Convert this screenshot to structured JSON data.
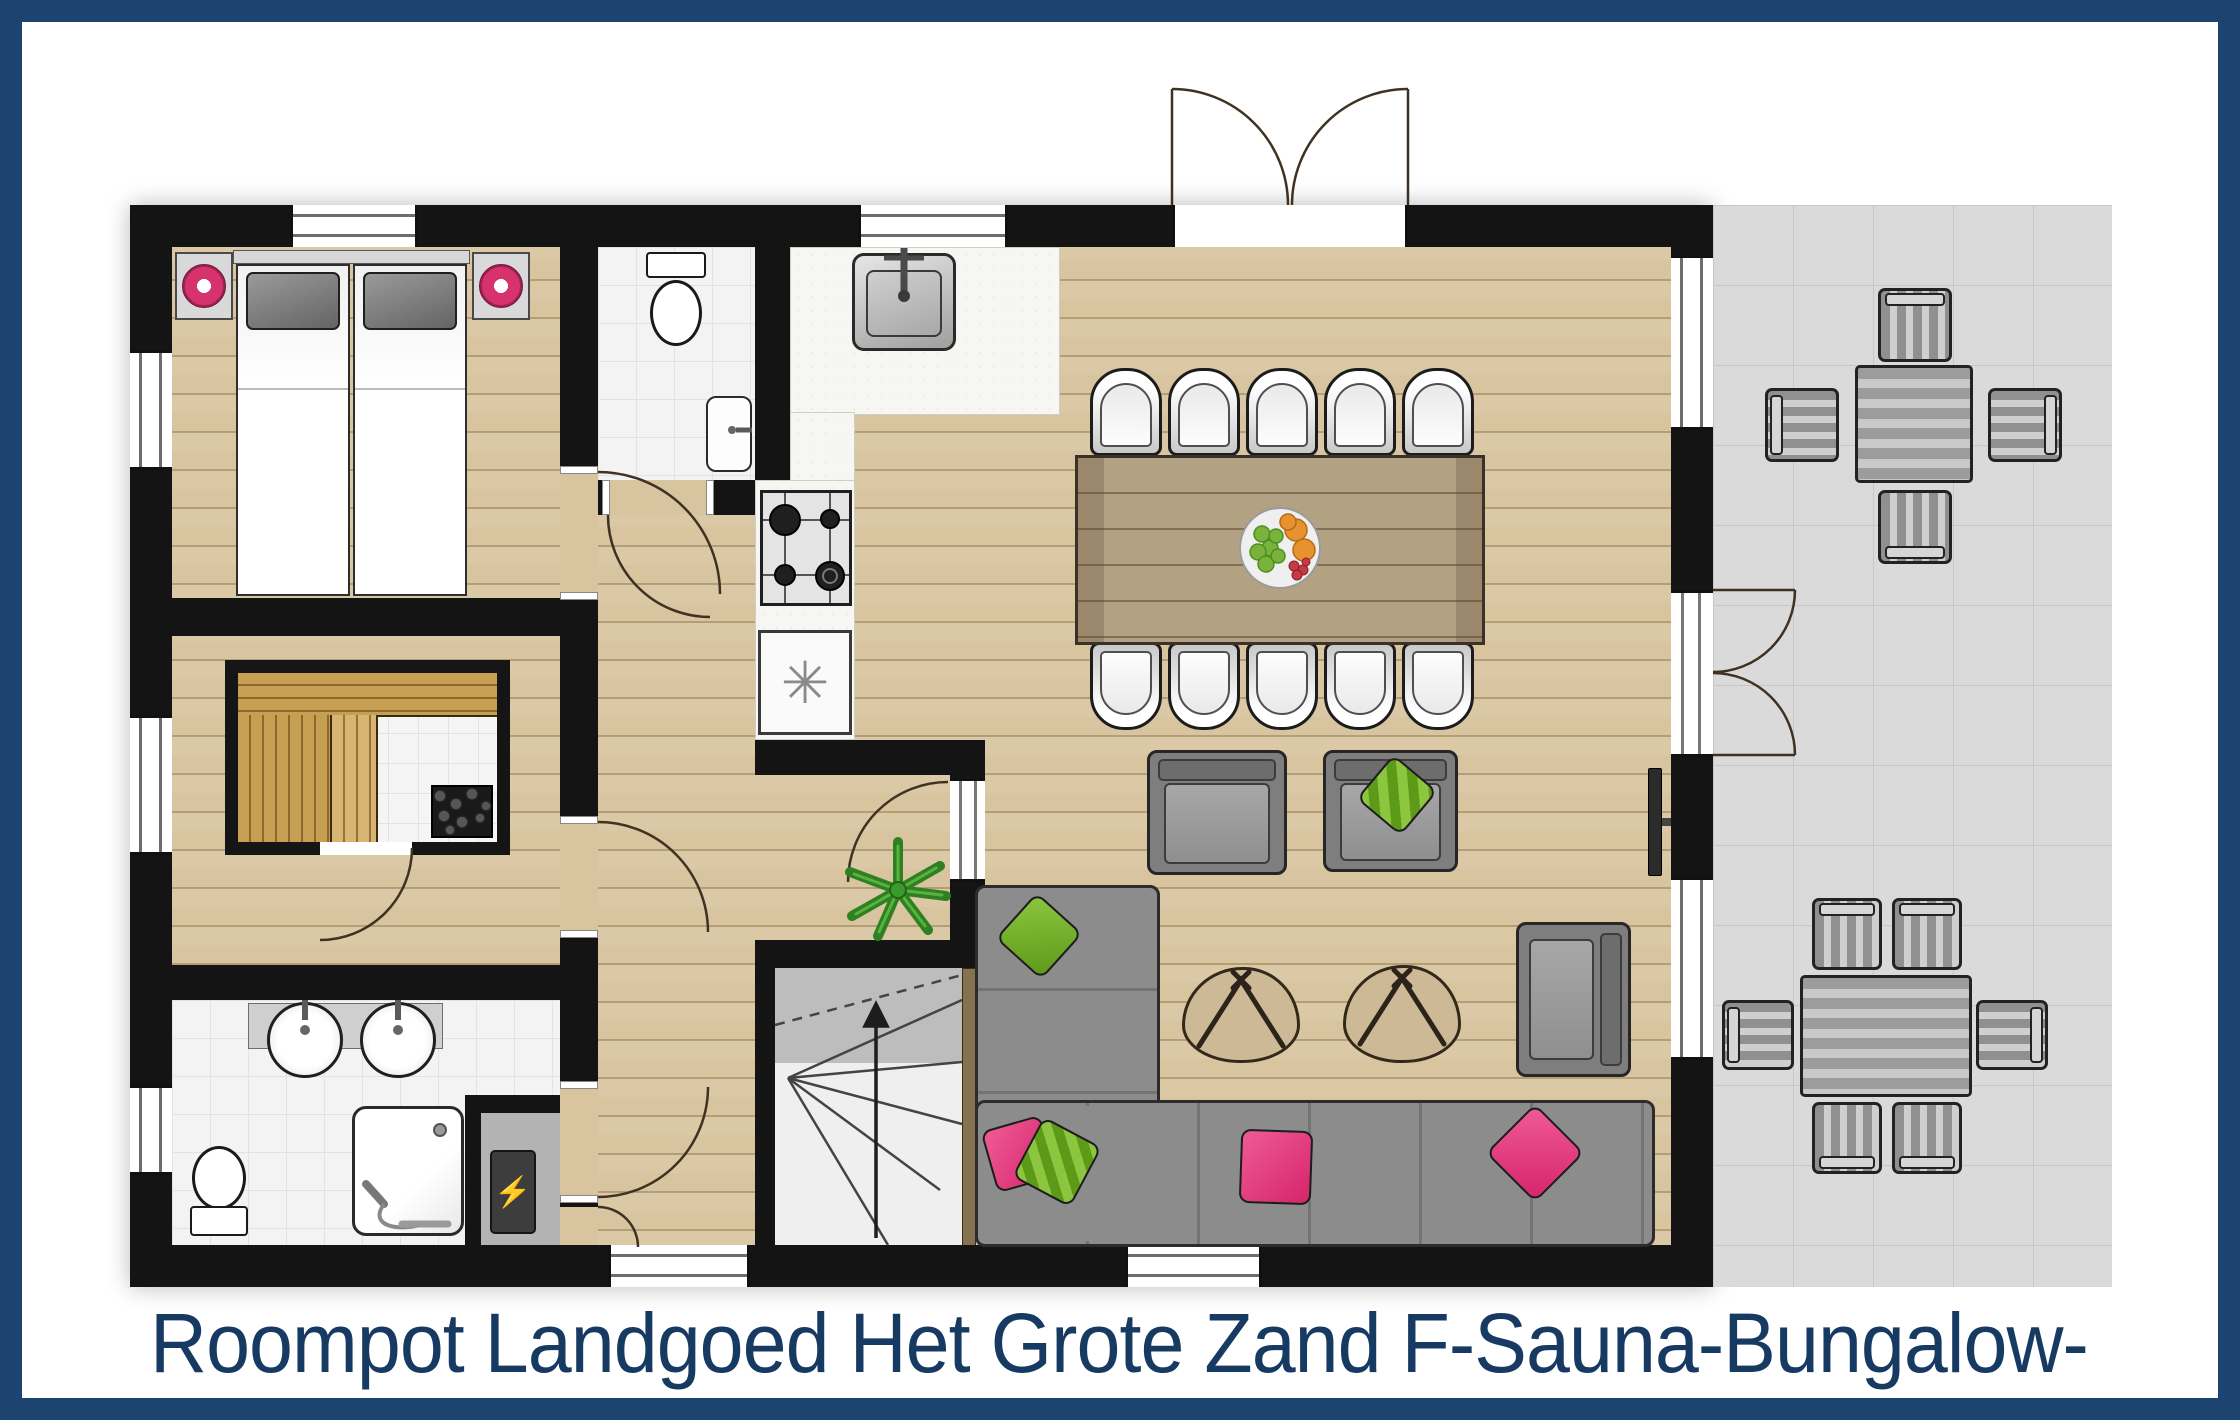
{
  "caption": {
    "text": "Roompot Landgoed Het Grote Zand F-Sauna-Bungalow-"
  },
  "symbols": {
    "freezer": "✳",
    "boiler": "⚡"
  },
  "colors": {
    "frame_navy": "#1d4370",
    "caption_navy": "#173a63",
    "wall_black": "#141414",
    "wood_floor": "#d8c49e",
    "tile_white": "#f3f3f3",
    "patio_gray": "#dadada",
    "sauna_wood": "#c79f52",
    "sofa_gray": "#8c8c8c",
    "accent_pink": "#d6336c",
    "accent_green": "#7fb32a",
    "table_wood": "#b3a184"
  },
  "legend": {
    "rooms": [
      "bedroom-1",
      "toilet-room",
      "kitchen",
      "dining-area",
      "living-room",
      "bedroom-2-with-sauna",
      "bathroom",
      "technical-closet",
      "hallway",
      "staircase",
      "terrace"
    ],
    "furniture_icons": [
      "double-bed",
      "nightstand-lamp",
      "toilet",
      "hand-basin",
      "kitchen-sink",
      "gas-hob",
      "freezer",
      "dining-table-10-chairs",
      "fruit-bowl",
      "corner-sofa",
      "armchair",
      "side-table",
      "lounge-chair",
      "tv",
      "plant",
      "sauna-bench",
      "sauna-heater",
      "double-washbasin",
      "shower",
      "boiler",
      "patio-dining-set-4",
      "patio-dining-set-6",
      "entrance-double-door",
      "garden-double-door"
    ]
  }
}
